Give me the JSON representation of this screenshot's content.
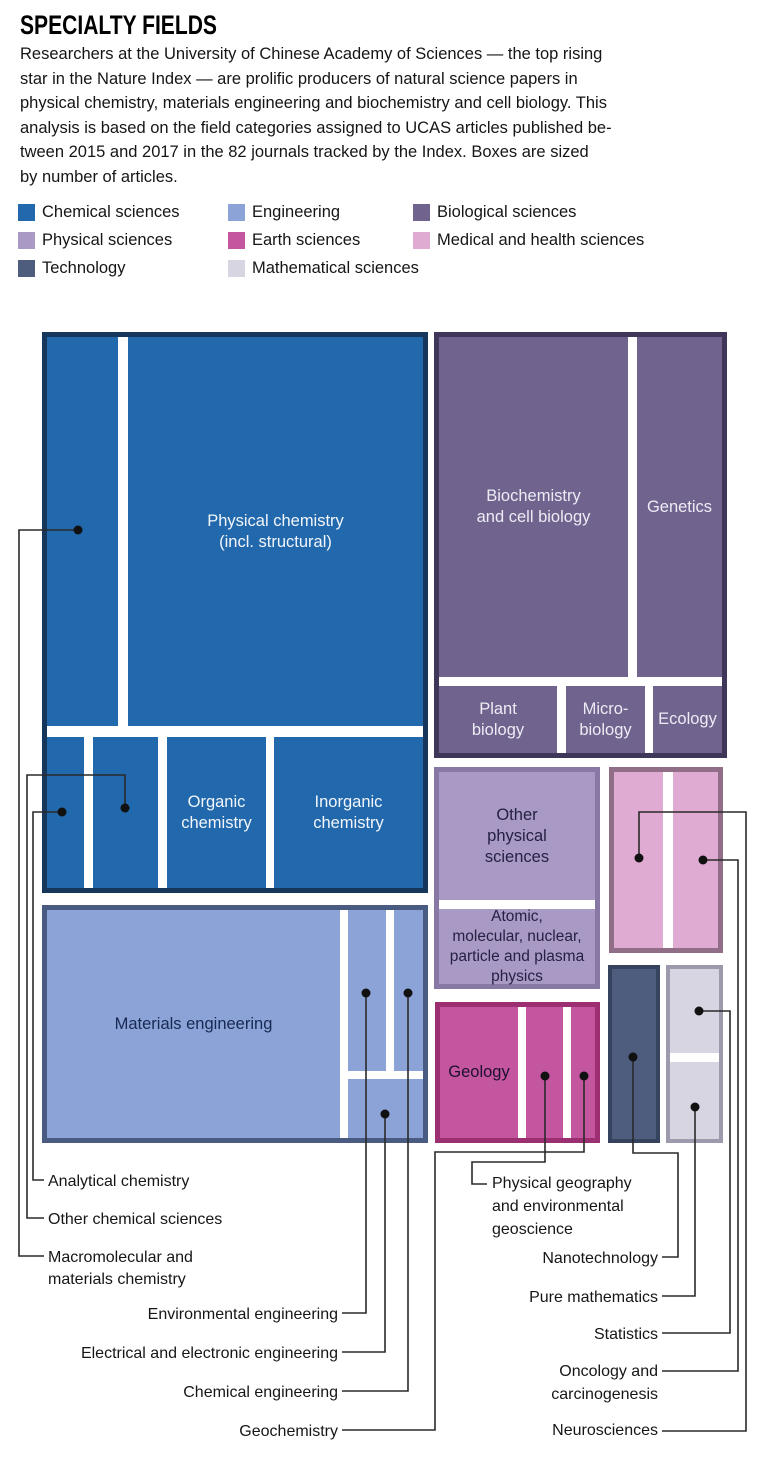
{
  "header": {
    "title": "SPECIALTY FIELDS",
    "intro": "Researchers at the University of Chinese Academy of Sciences — the top rising\nstar in the Nature Index — are prolific producers of natural science papers in\nphysical chemistry, materials engineering and biochemistry and cell biology. This\nanalysis is based on the field categories assigned to UCAS articles published be-\ntween 2015 and 2017 in the 82 journals tracked by the Index. Boxes are sized\nby number of articles."
  },
  "colors": {
    "chemical": "#2268AC",
    "engineering": "#8CA3D8",
    "biological": "#70648F",
    "physical": "#A89AC5",
    "earth": "#C4559F",
    "medical": "#E0ABD3",
    "technology": "#4E5C7E",
    "mathematical": "#D8D5E3"
  },
  "legend": {
    "items": [
      {
        "label": "Chemical sciences",
        "color": "#2268AC"
      },
      {
        "label": "Engineering",
        "color": "#8CA3D8"
      },
      {
        "label": "Biological sciences",
        "color": "#70648F"
      },
      {
        "label": "Physical sciences",
        "color": "#A89AC5"
      },
      {
        "label": "Earth sciences",
        "color": "#C4559F"
      },
      {
        "label": "Medical and health sciences",
        "color": "#E0ABD3"
      },
      {
        "label": "Technology",
        "color": "#4E5C7E"
      },
      {
        "label": "Mathematical sciences",
        "color": "#D8D5E3"
      }
    ]
  },
  "treemap": {
    "boxes": {
      "physical_chemistry": "Physical chemistry\n(incl. structural)",
      "organic_chemistry": "Organic\nchemistry",
      "inorganic_chemistry": "Inorganic\nchemistry",
      "materials_engineering": "Materials engineering",
      "biochemistry": "Biochemistry\nand cell biology",
      "genetics": "Genetics",
      "plant_biology": "Plant\nbiology",
      "microbiology": "Micro-\nbiology",
      "ecology": "Ecology",
      "other_physical": "Other\nphysical\nsciences",
      "atomic_physics": "Atomic,\nmolecular, nuclear,\nparticle and plasma\nphysics",
      "geology": "Geology"
    }
  },
  "callouts": {
    "analytical": "Analytical chemistry",
    "other_chemical": "Other chemical sciences",
    "macromolecular": "Macromolecular and\nmaterials chemistry",
    "environmental": "Environmental engineering",
    "electrical": "Electrical and electronic engineering",
    "chemical_eng": "Chemical engineering",
    "geochemistry": "Geochemistry",
    "physical_geography": "Physical geography\nand environmental\ngeoscience",
    "nanotechnology": "Nanotechnology",
    "pure_math": "Pure mathematics",
    "statistics": "Statistics",
    "oncology": "Oncology and\ncarcinogenesis",
    "neurosciences": "Neurosciences"
  },
  "chart_data": {
    "type": "treemap",
    "title": "SPECIALTY FIELDS",
    "sizing": "Boxes are sized by number of articles (no numeric labels shown)",
    "groups": [
      {
        "group": "Chemical sciences",
        "color": "#2268AC",
        "fields": [
          {
            "name": "Physical chemistry (incl. structural)",
            "relative_area": 115
          },
          {
            "name": "Macromolecular and materials chemistry",
            "relative_area": 28
          },
          {
            "name": "Inorganic chemistry",
            "relative_area": 22
          },
          {
            "name": "Organic chemistry",
            "relative_area": 15
          },
          {
            "name": "Other chemical sciences",
            "relative_area": 10
          },
          {
            "name": "Analytical chemistry",
            "relative_area": 6
          }
        ]
      },
      {
        "group": "Engineering",
        "color": "#8CA3D8",
        "fields": [
          {
            "name": "Materials engineering",
            "relative_area": 67
          },
          {
            "name": "Environmental engineering",
            "relative_area": 6
          },
          {
            "name": "Chemical engineering",
            "relative_area": 5
          },
          {
            "name": "Electrical and electronic engineering",
            "relative_area": 4
          }
        ]
      },
      {
        "group": "Biological sciences",
        "color": "#70648F",
        "fields": [
          {
            "name": "Biochemistry and cell biology",
            "relative_area": 64
          },
          {
            "name": "Genetics",
            "relative_area": 29
          },
          {
            "name": "Plant biology",
            "relative_area": 8
          },
          {
            "name": "Microbiology",
            "relative_area": 5
          },
          {
            "name": "Ecology",
            "relative_area": 5
          }
        ]
      },
      {
        "group": "Physical sciences",
        "color": "#A89AC5",
        "fields": [
          {
            "name": "Other physical sciences",
            "relative_area": 20
          },
          {
            "name": "Atomic, molecular, nuclear, particle and plasma physics",
            "relative_area": 12
          }
        ]
      },
      {
        "group": "Earth sciences",
        "color": "#C4559F",
        "fields": [
          {
            "name": "Geology",
            "relative_area": 10
          },
          {
            "name": "Physical geography and environmental geoscience",
            "relative_area": 5
          },
          {
            "name": "Geochemistry",
            "relative_area": 3
          }
        ]
      },
      {
        "group": "Medical and health sciences",
        "color": "#E0ABD3",
        "fields": [
          {
            "name": "Neurosciences",
            "relative_area": 9
          },
          {
            "name": "Oncology and carcinogenesis",
            "relative_area": 8
          }
        ]
      },
      {
        "group": "Technology",
        "color": "#4E5C7E",
        "fields": [
          {
            "name": "Nanotechnology",
            "relative_area": 8
          }
        ]
      },
      {
        "group": "Mathematical sciences",
        "color": "#D8D5E3",
        "fields": [
          {
            "name": "Statistics",
            "relative_area": 4
          },
          {
            "name": "Pure mathematics",
            "relative_area": 4
          }
        ]
      }
    ]
  }
}
